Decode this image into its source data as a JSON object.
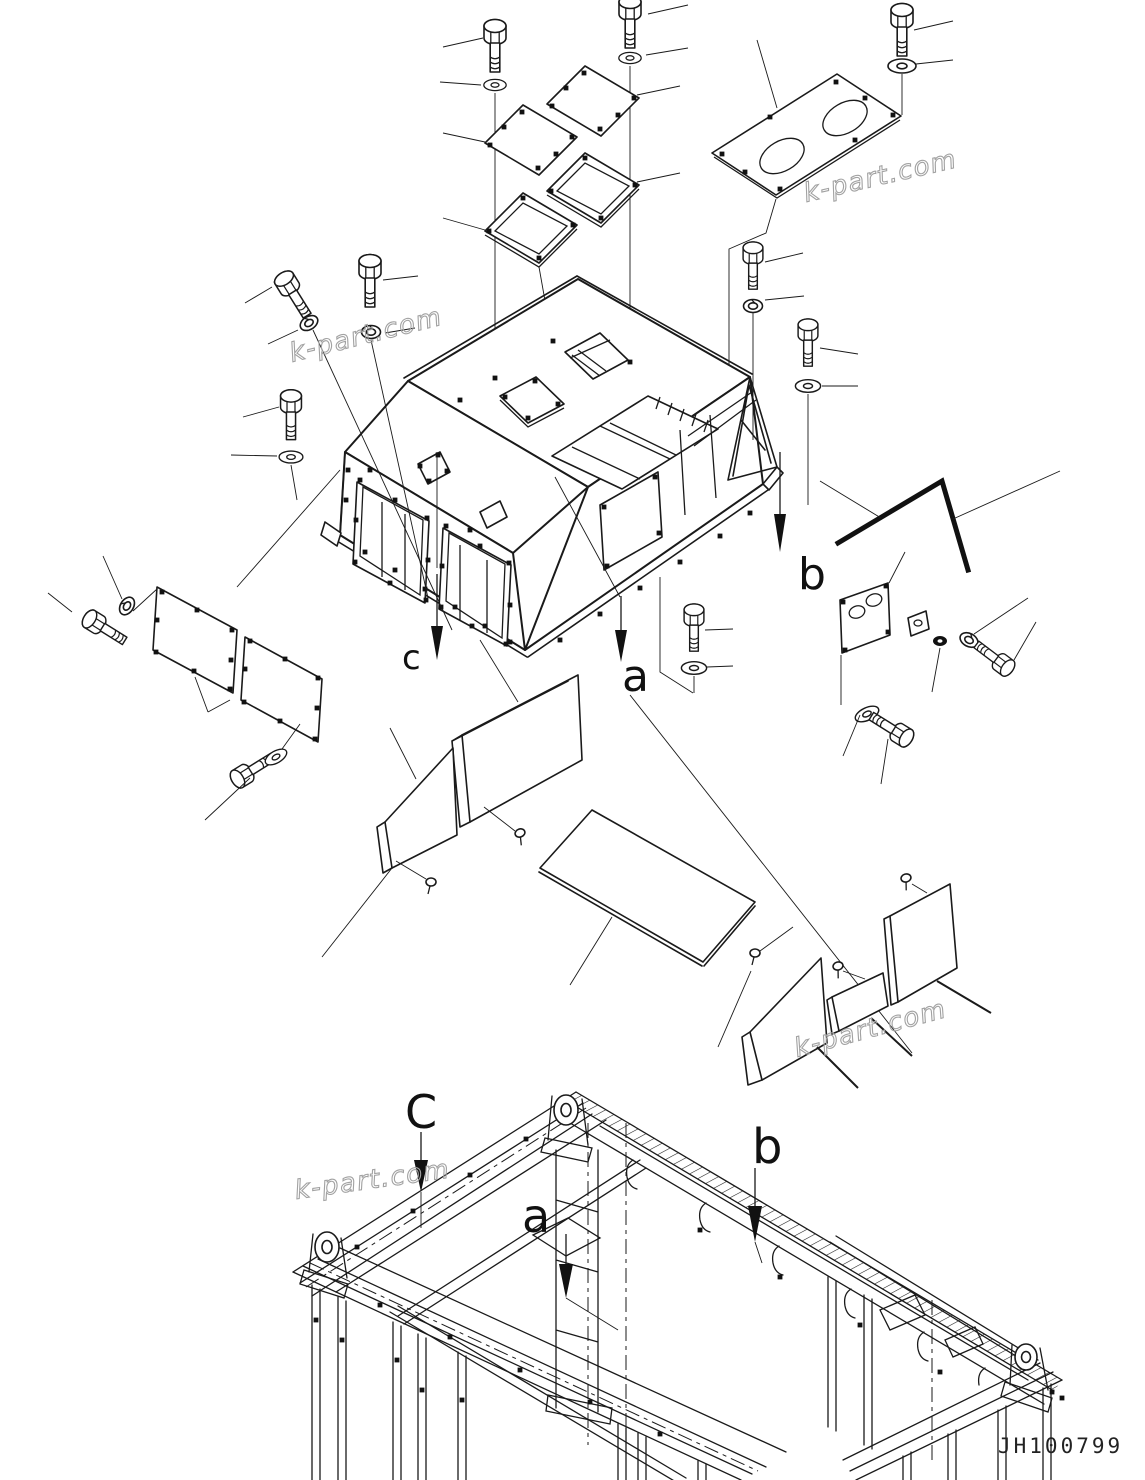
{
  "diagram": {
    "drawing_number": "JH100799",
    "watermark_text": "k-part.com",
    "colors": {
      "line": "#1a1a1a",
      "watermark": "#a2a2a2",
      "background": "#ffffff"
    },
    "labels": {
      "upper": {
        "c": "c",
        "a": "a",
        "b": "b"
      },
      "lower": {
        "c": "C",
        "a": "a",
        "b": "b"
      }
    }
  }
}
